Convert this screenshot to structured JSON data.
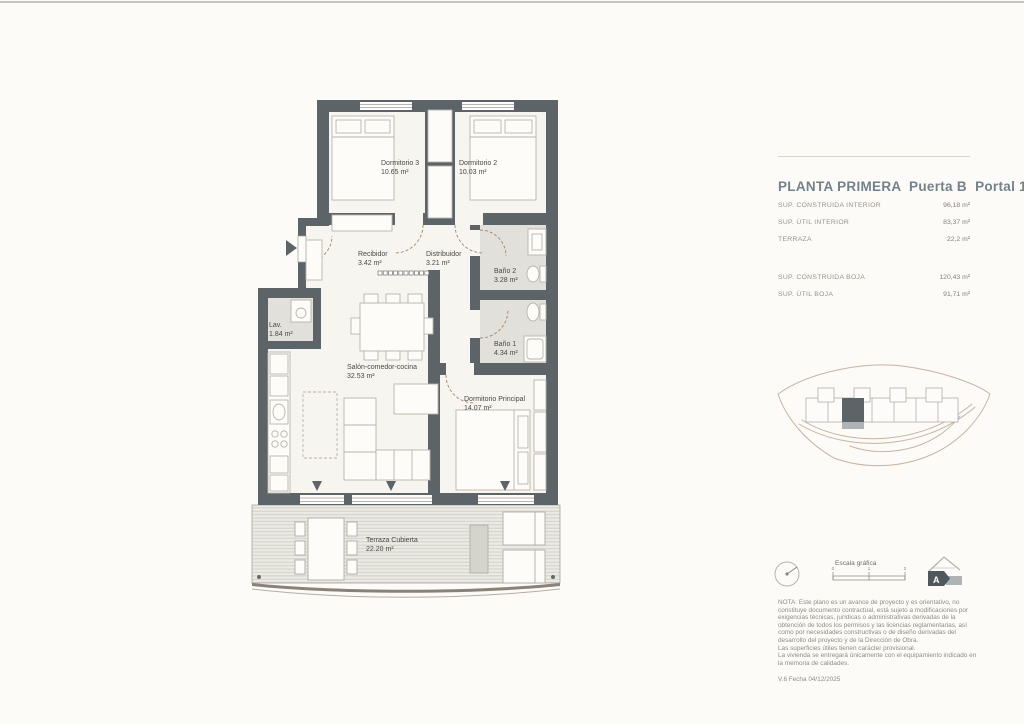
{
  "info_panel": {
    "title": "PLANTA PRIMERA  Puerta B  Portal 1",
    "areas_group1": [
      {
        "label": "SUP. CONSTRUIDA INTERIOR",
        "value": "96,18 m²"
      },
      {
        "label": "SUP. ÚTIL INTERIOR",
        "value": "83,37 m²"
      },
      {
        "label": "TERRAZA",
        "value": "22,2 m²"
      }
    ],
    "areas_group2": [
      {
        "label": "SUP. CONSTRUIDA BOJA",
        "value": "120,43 m²"
      },
      {
        "label": "SUP. ÚTIL BOJA",
        "value": "91,71 m²"
      }
    ]
  },
  "plan": {
    "rooms": {
      "dormitorio3": {
        "name": "Dormitorio 3",
        "area": "10.65 m²"
      },
      "dormitorio2": {
        "name": "Dormitorio 2",
        "area": "10.03 m²"
      },
      "recibidor": {
        "name": "Recibidor",
        "area": "3.42 m²"
      },
      "distribuidor": {
        "name": "Distribuidor",
        "area": "3.21 m²"
      },
      "bano2": {
        "name": "Baño 2",
        "area": "3.28 m²"
      },
      "bano1": {
        "name": "Baño 1",
        "area": "4.34 m²"
      },
      "lavadero": {
        "name": "Lav.",
        "area": "1.84 m²"
      },
      "salon": {
        "name": "Salón-comedor-cocina",
        "area": "32.53 m²"
      },
      "dormitorio_principal": {
        "name": "Dormitorio Principal",
        "area": "14.07 m²"
      },
      "terraza": {
        "name": "Terraza Cubierta",
        "area": "22.20 m²"
      }
    }
  },
  "legend": {
    "escala_label": "Escala gráfica",
    "scale_ticks": [
      "0",
      "1",
      "2"
    ],
    "energy_rating": "A"
  },
  "notes": {
    "nota": "NOTA: Este plano es un avance de proyecto y es orientativo, no constituye documento contractual, está sujeto a modificaciones por exigencias técnicas, jurídicas o administrativas derivadas de la obtención de todos los permisos y las licencias reglamentarias, así como por necesidades constructivas o de diseño derivadas del desarrollo del proyecto y de la Dirección de Obra.",
    "line2": "Las superficies útiles tienen carácter provisional.",
    "line3": "La vivienda se entregará únicamente con el equipamiento indicado en la memoria de calidades.",
    "version": "V.6 Fecha 04/12/2025"
  },
  "colors": {
    "wall": "#5d6468",
    "room_fill": "#f7f5f0",
    "wet_floor": "#e2e0da",
    "title_accent": "#73828a",
    "site_outline": "#c9b39e"
  }
}
